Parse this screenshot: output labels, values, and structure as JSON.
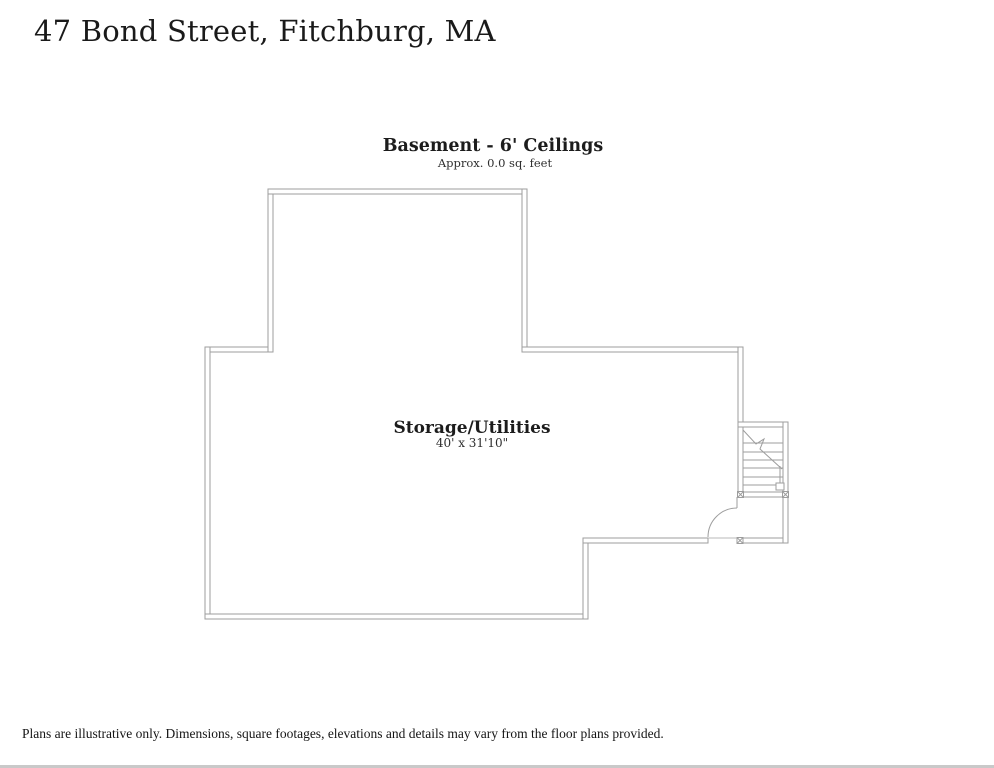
{
  "page": {
    "title": "47 Bond Street, Fitchburg, MA",
    "disclaimer": "Plans are illustrative only. Dimensions, square footages, elevations and details may vary from the floor plans provided."
  },
  "floor_plan": {
    "heading": "Basement - 6' Ceilings",
    "subheading": "Approx. 0.0 sq. feet",
    "room": {
      "name": "Storage/Utilities",
      "dimensions": "40' x 31'10\""
    },
    "colors": {
      "wall_line": "#9d9d9d",
      "text": "#1c1c1c",
      "footer_bar": "#c9c9c9"
    }
  }
}
